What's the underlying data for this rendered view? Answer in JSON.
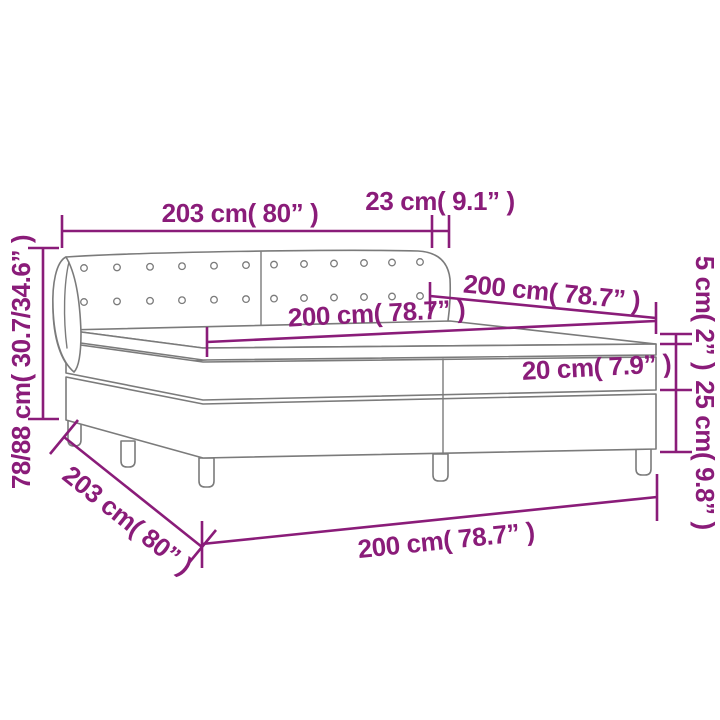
{
  "diagram": {
    "kind": "product-dimension-diagram",
    "subject": "box-spring-bed-with-headboard",
    "palette": {
      "dimension_color": "#8A1C79",
      "outline_color": "#7b7b7b",
      "background": "#ffffff"
    },
    "annotations": {
      "headboard_width": {
        "label": "203 cm( 80” )"
      },
      "wing_depth": {
        "label": "23 cm( 9.1” )"
      },
      "overall_height": {
        "label": "78/88 cm( 30.7/34.6” )"
      },
      "bed_depth": {
        "label": "200 cm( 78.7” )"
      },
      "mattress_width": {
        "label": "200 cm( 78.7” )"
      },
      "topper_thickness": {
        "label": "5 cm( 2” )"
      },
      "mattress_thickness": {
        "label": "20 cm( 7.9” )"
      },
      "base_height": {
        "label": "25 cm( 9.8” )"
      },
      "base_depth": {
        "label": "203 cm( 80” )"
      },
      "base_width": {
        "label": "200 cm( 78.7” )"
      }
    }
  }
}
